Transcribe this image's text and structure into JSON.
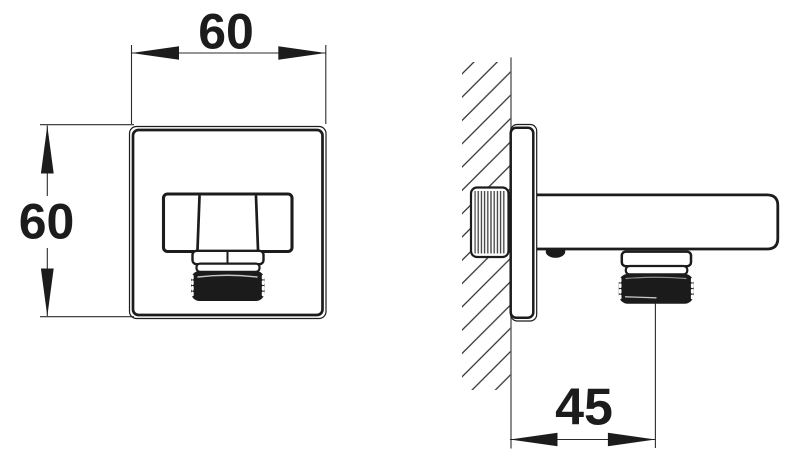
{
  "colors": {
    "background": "#ffffff",
    "line": "#1c1c1c",
    "dim_line": "#2b2b2b",
    "wall_line": "#5c5c5c",
    "hatch_line": "#303030",
    "thread_line": "#3c3c3c",
    "dark_fill": "#1b1b1b",
    "highlight": "#ffffff"
  },
  "front_view": {
    "width_label": "60",
    "height_label": "60"
  },
  "side_view": {
    "offset_label": "45"
  }
}
